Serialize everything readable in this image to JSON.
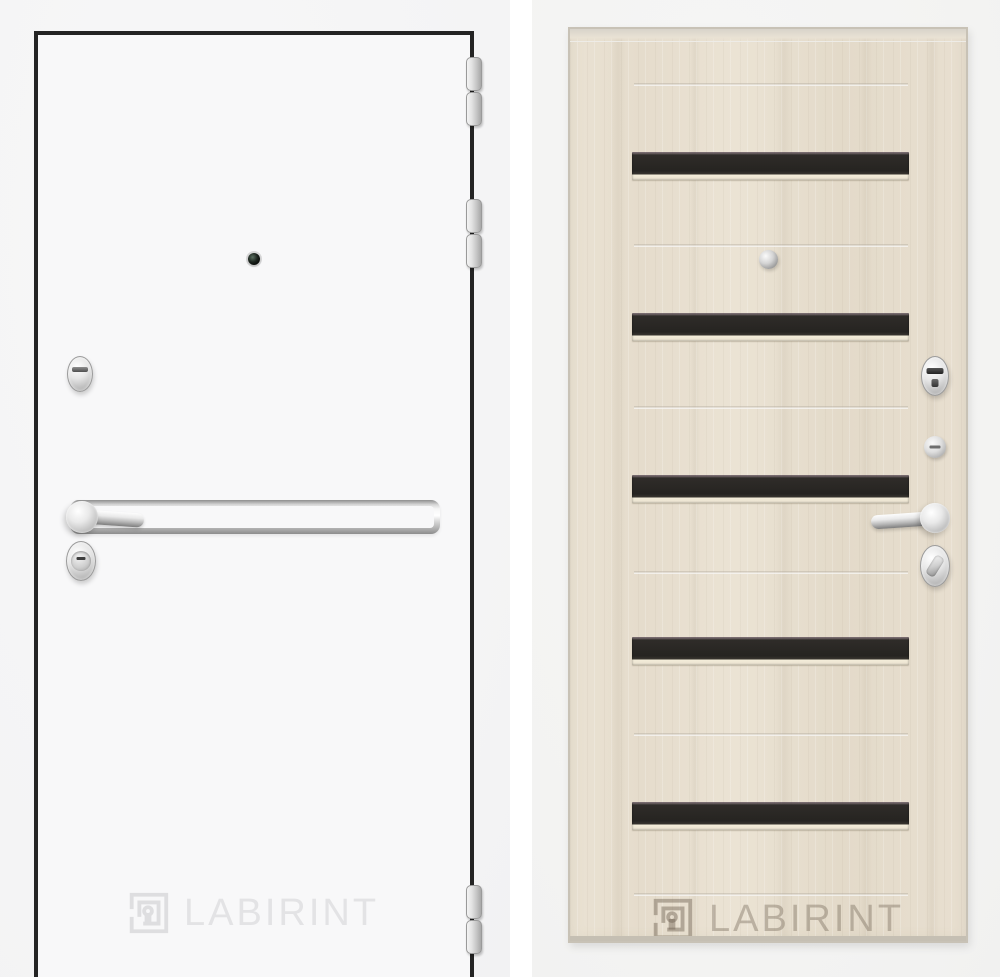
{
  "brand": {
    "watermark_text": "LABIRINT",
    "logo_icon": "labirint-maze-icon"
  },
  "left_door": {
    "description": "white exterior door leaf, front side",
    "watermark": {
      "text": "LABIRINT",
      "color": "#e3e3e5"
    },
    "colors": {
      "photo_background": "#f4f4f5",
      "door_leaf": "#f8f8f9",
      "outline": "#242424",
      "chrome_hardware": "#c9c9c9"
    },
    "hardware": {
      "hinge_count": 3,
      "items": [
        "door-hinges",
        "peephole",
        "thumbturn-lock",
        "lever-handle-with-chrome-trim-bar",
        "cylinder-lock"
      ]
    }
  },
  "right_door": {
    "description": "light oak interior door panel with dark glass stripes",
    "watermark": {
      "text": "LABIRINT",
      "color": "rgba(110,98,82,0.38)"
    },
    "colors": {
      "photo_background": "#f3f3f2",
      "wood": "#e6ddcd",
      "glass_stripe": "#2e2b28",
      "groove": "#f1ead9"
    },
    "glass_stripe_count": 5,
    "hardware": [
      "peephole",
      "escutcheon-lock",
      "night-latch-knob",
      "lever-handle",
      "oval-thumbturn"
    ]
  }
}
